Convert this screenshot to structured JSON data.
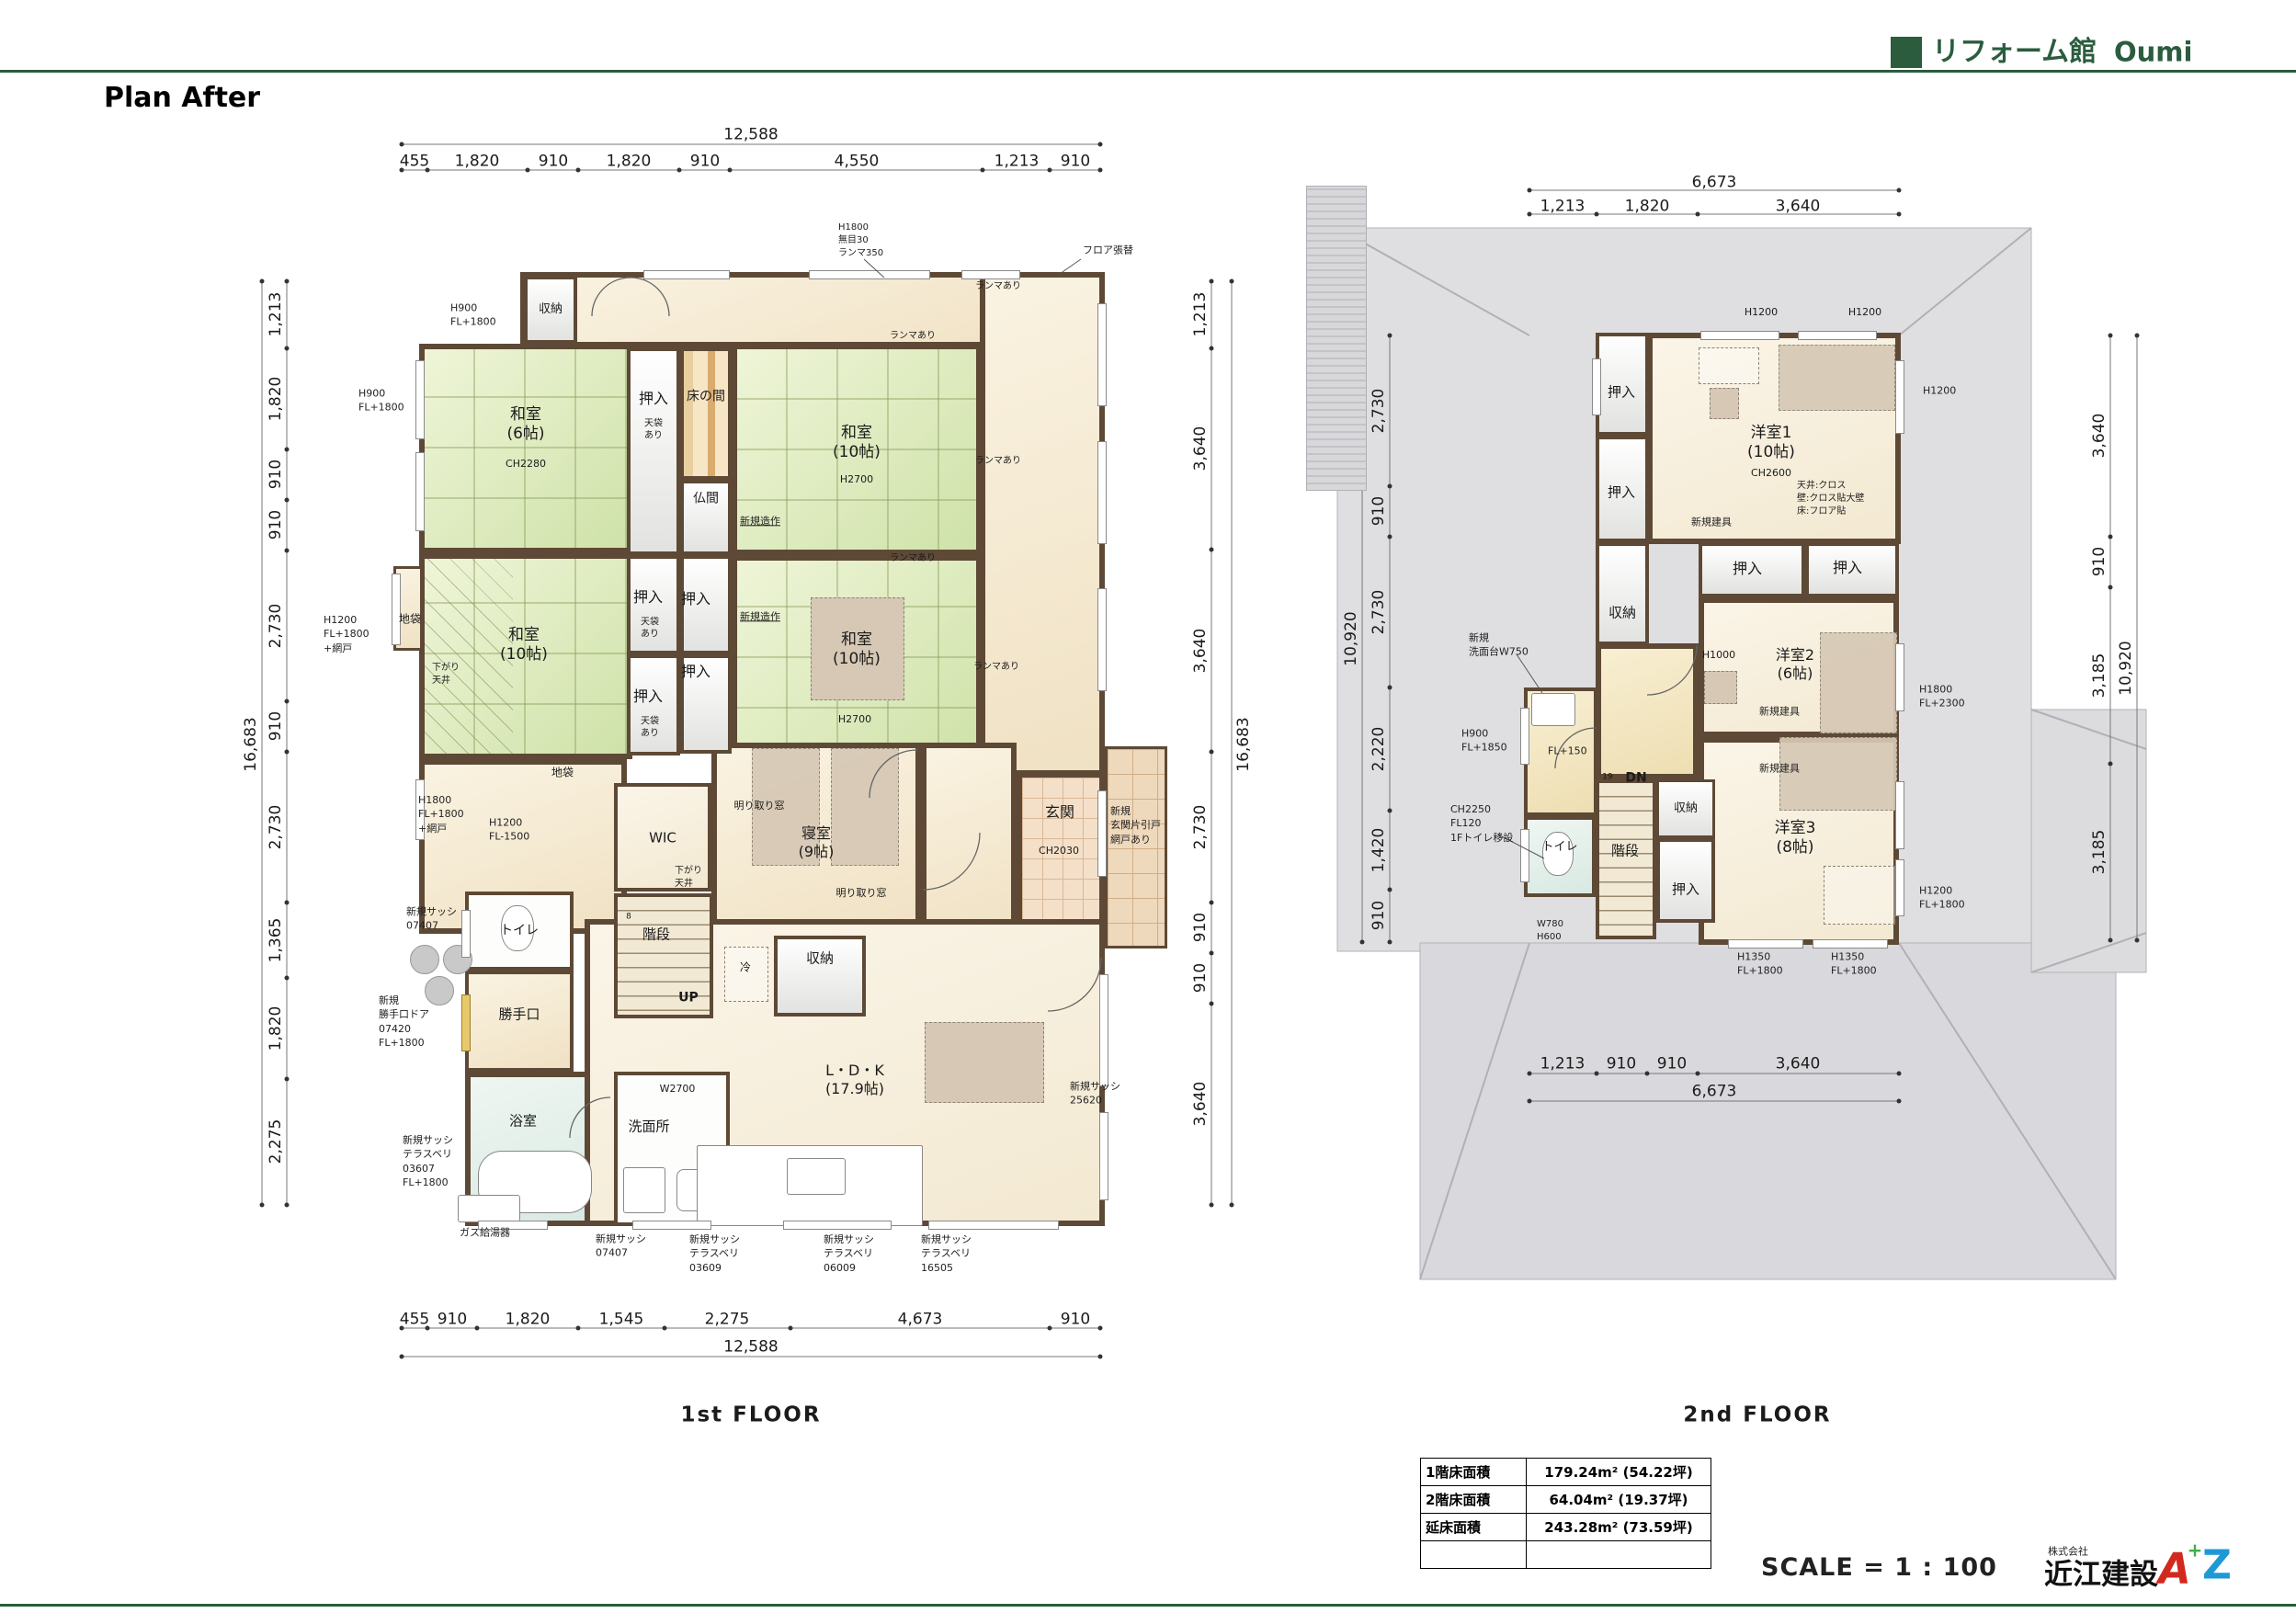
{
  "colors": {
    "brand_green": "#2b5c3e",
    "wall_brown": "#5d4935",
    "tatami_green": "#d9e6b4",
    "floor_cream": "#f6ecd6",
    "roof_gray": "#dfdfe2",
    "logo_red": "#d2291e",
    "logo_blue": "#1d9ad6",
    "logo_green": "#3fae49"
  },
  "header": {
    "brand": "リフォーム館",
    "brand_suffix": "Oumi",
    "plan_title": "Plan After"
  },
  "footer": {
    "scale_label": "SCALE = 1 : 100",
    "company_prefix": "株式会社",
    "company_name": "近江建設",
    "logo_a": "A",
    "logo_plus": "+",
    "logo_z": "Z"
  },
  "floors": {
    "f1_title": "1st FLOOR",
    "f2_title": "2nd FLOOR"
  },
  "common": {
    "oshiire": "押入",
    "tenbukuro": "天袋\nあり",
    "shuno": "収納",
    "jibukuro": "地袋",
    "ranma": "ランマあり",
    "zosaku": "新規造作",
    "h2700": "H2700",
    "sagari_tenjo": "下がり\n天井",
    "kaidan": "階段",
    "toilet": "トイレ",
    "tategu": "新規建具",
    "h1200": "H1200",
    "akari": "明り取り窓",
    "washitsu10": "和室\n(10帖)",
    "h1350_fl1800": "H1350\nFL+1800",
    "sash_07407": "新規サッシ\n07407",
    "h900_fl1800": "H900\nFL+1800"
  },
  "f1": {
    "rooms": {
      "washitsu6": "和室\n(6帖)",
      "ch2280": "CH2280",
      "tokonoma": "床の間",
      "butsuma": "仏間",
      "shinshitsu": "寝室\n(9帖)",
      "wic": "WIC",
      "up": "UP",
      "steps8": "8",
      "genkan": "玄関",
      "ch2030": "CH2030",
      "rei": "冷",
      "ldk": "L・D・K\n(17.9帖)",
      "katteguchi": "勝手口",
      "yokushitsu": "浴室",
      "senmenjo": "洗面所"
    },
    "ann": {
      "h1800_mume": "H1800\n無目30\nランマ350",
      "floor_replace": "フロア張替",
      "h1200_ami": "H1200\nFL+1800\n+網戸",
      "h1800_ami": "H1800\nFL+1800\n+網戸",
      "h1200_fl1500": "H1200\nFL-1500",
      "katte_door": "新規\n勝手口ドア\n07420\nFL+1800",
      "sash_03607": "新規サッシ\nテラスベリ\n03607\nFL+1800",
      "gas": "ガス給湯器",
      "sash_03609": "新規サッシ\nテラスベリ\n03609",
      "sash_06009": "新規サッシ\nテラスベリ\n06009",
      "sash_16505": "新規サッシ\nテラスベリ\n16505",
      "sash_25620": "新規サッシ\n25620",
      "genkan_door": "新規\n玄関片引戸\n網戸あり",
      "w2700": "W2700"
    },
    "dims": {
      "top_total": "12,588",
      "top": [
        "455",
        "1,820",
        "910",
        "1,820",
        "910",
        "4,550",
        "1,213",
        "910"
      ],
      "bottom": [
        "455",
        "910",
        "1,820",
        "1,545",
        "2,275",
        "4,673",
        "910"
      ],
      "bottom_total": "12,588",
      "left": [
        "1,213",
        "1,820",
        "910",
        "910",
        "2,730",
        "910",
        "2,730",
        "1,365",
        "1,820",
        "2,275"
      ],
      "left_total": "16,683",
      "right": [
        "1,213",
        "3,640",
        "3,640",
        "2,730",
        "910",
        "910",
        "3,640"
      ],
      "right_total": "16,683"
    }
  },
  "f2": {
    "rooms": {
      "yoshitsu1": "洋室1\n(10帖)",
      "ch2600": "CH2600",
      "spec": "天井:クロス\n壁:クロス貼大壁\n床:フロア貼",
      "yoshitsu2": "洋室2\n(6帖)",
      "h1000": "H1000",
      "yoshitsu3": "洋室3\n(8帖)",
      "dn": "DN",
      "steps19": "19"
    },
    "ann": {
      "senmendai": "新規\n洗面台W750",
      "h900_fl1850": "H900\nFL+1850",
      "fl150": "FL+150",
      "ch2250": "CH2250\nFL120\n1Fトイレ移設",
      "w780": "W780\nH600",
      "h1800_fl2300": "H1800\nFL+2300",
      "h1200_fl1800": "H1200\nFL+1800"
    },
    "dims": {
      "top_total": "6,673",
      "top": [
        "1,213",
        "1,820",
        "3,640"
      ],
      "bottom": [
        "1,213",
        "910",
        "910",
        "3,640"
      ],
      "bottom_total": "6,673",
      "left": [
        "2,730",
        "910",
        "2,730",
        "2,220",
        "1,420",
        "910"
      ],
      "left_total": "10,920",
      "right": [
        "3,640",
        "910",
        "3,185",
        "3,185"
      ],
      "right_total": "10,920"
    }
  },
  "area_table": {
    "rows": [
      {
        "label": "1階床面積",
        "value": "179.24m² (54.22坪)"
      },
      {
        "label": "2階床面積",
        "value": "64.04m² (19.37坪)"
      },
      {
        "label": "延床面積",
        "value": "243.28m² (73.59坪)"
      },
      {
        "label": "",
        "value": ""
      }
    ]
  }
}
